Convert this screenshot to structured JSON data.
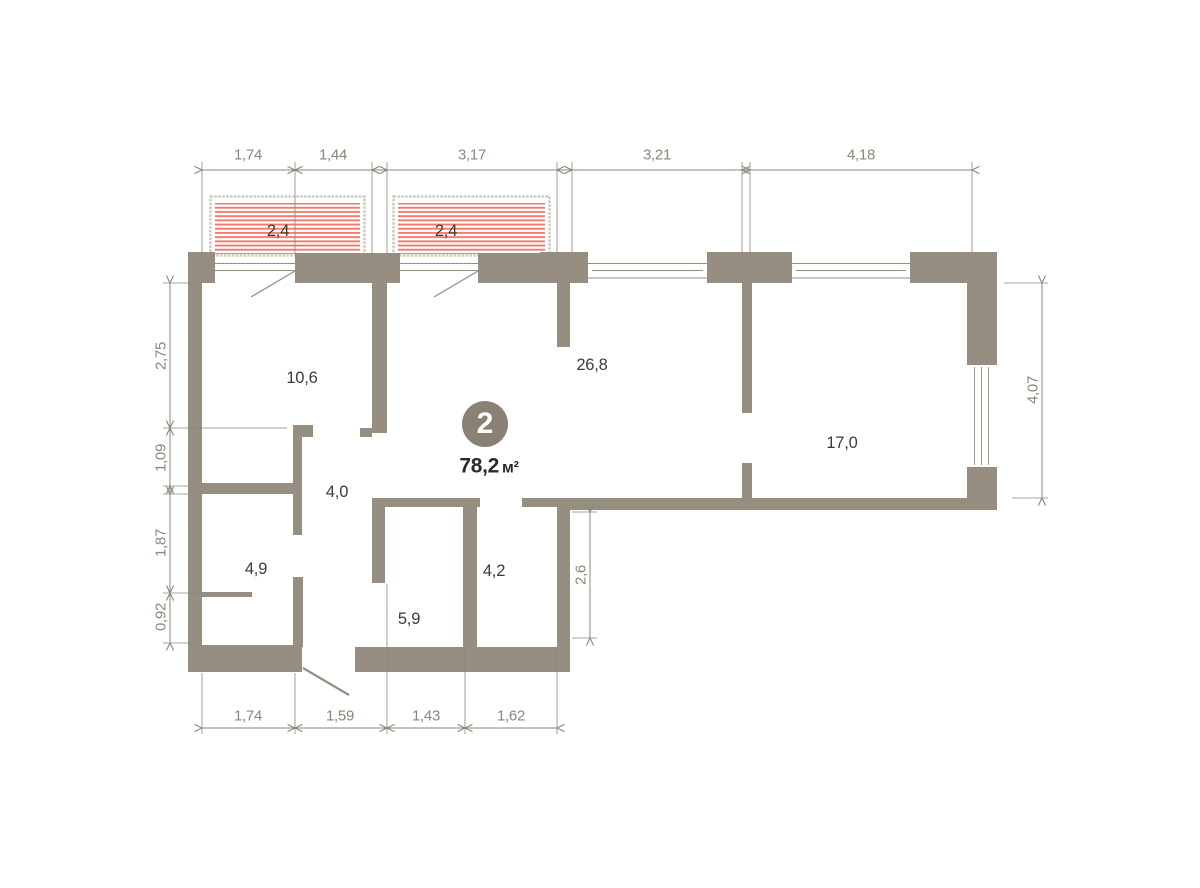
{
  "floor_plan": {
    "badge": {
      "number": "2",
      "area": "78,2",
      "unit": "м²"
    },
    "room_areas": [
      "2,4",
      "2,4",
      "10,6",
      "26,8",
      "17,0",
      "4,0",
      "4,9",
      "4,2",
      "5,9"
    ],
    "dimensions": {
      "top": [
        "1,74",
        "1,44",
        "3,17",
        "3,21",
        "4,18"
      ],
      "left": [
        "2,75",
        "1,09",
        "1,87",
        "0,92"
      ],
      "right": [
        "4,07"
      ],
      "bottom": [
        "1,74",
        "1,59",
        "1,43",
        "1,62"
      ],
      "interior": [
        "2,6"
      ]
    },
    "colors": {
      "wall": "#968e81",
      "dimension": "#8d8578",
      "room_label": "#3e3b36",
      "hatch": "#f0796b",
      "badge": "#8a8175",
      "railing": "#cfcbc3"
    }
  }
}
